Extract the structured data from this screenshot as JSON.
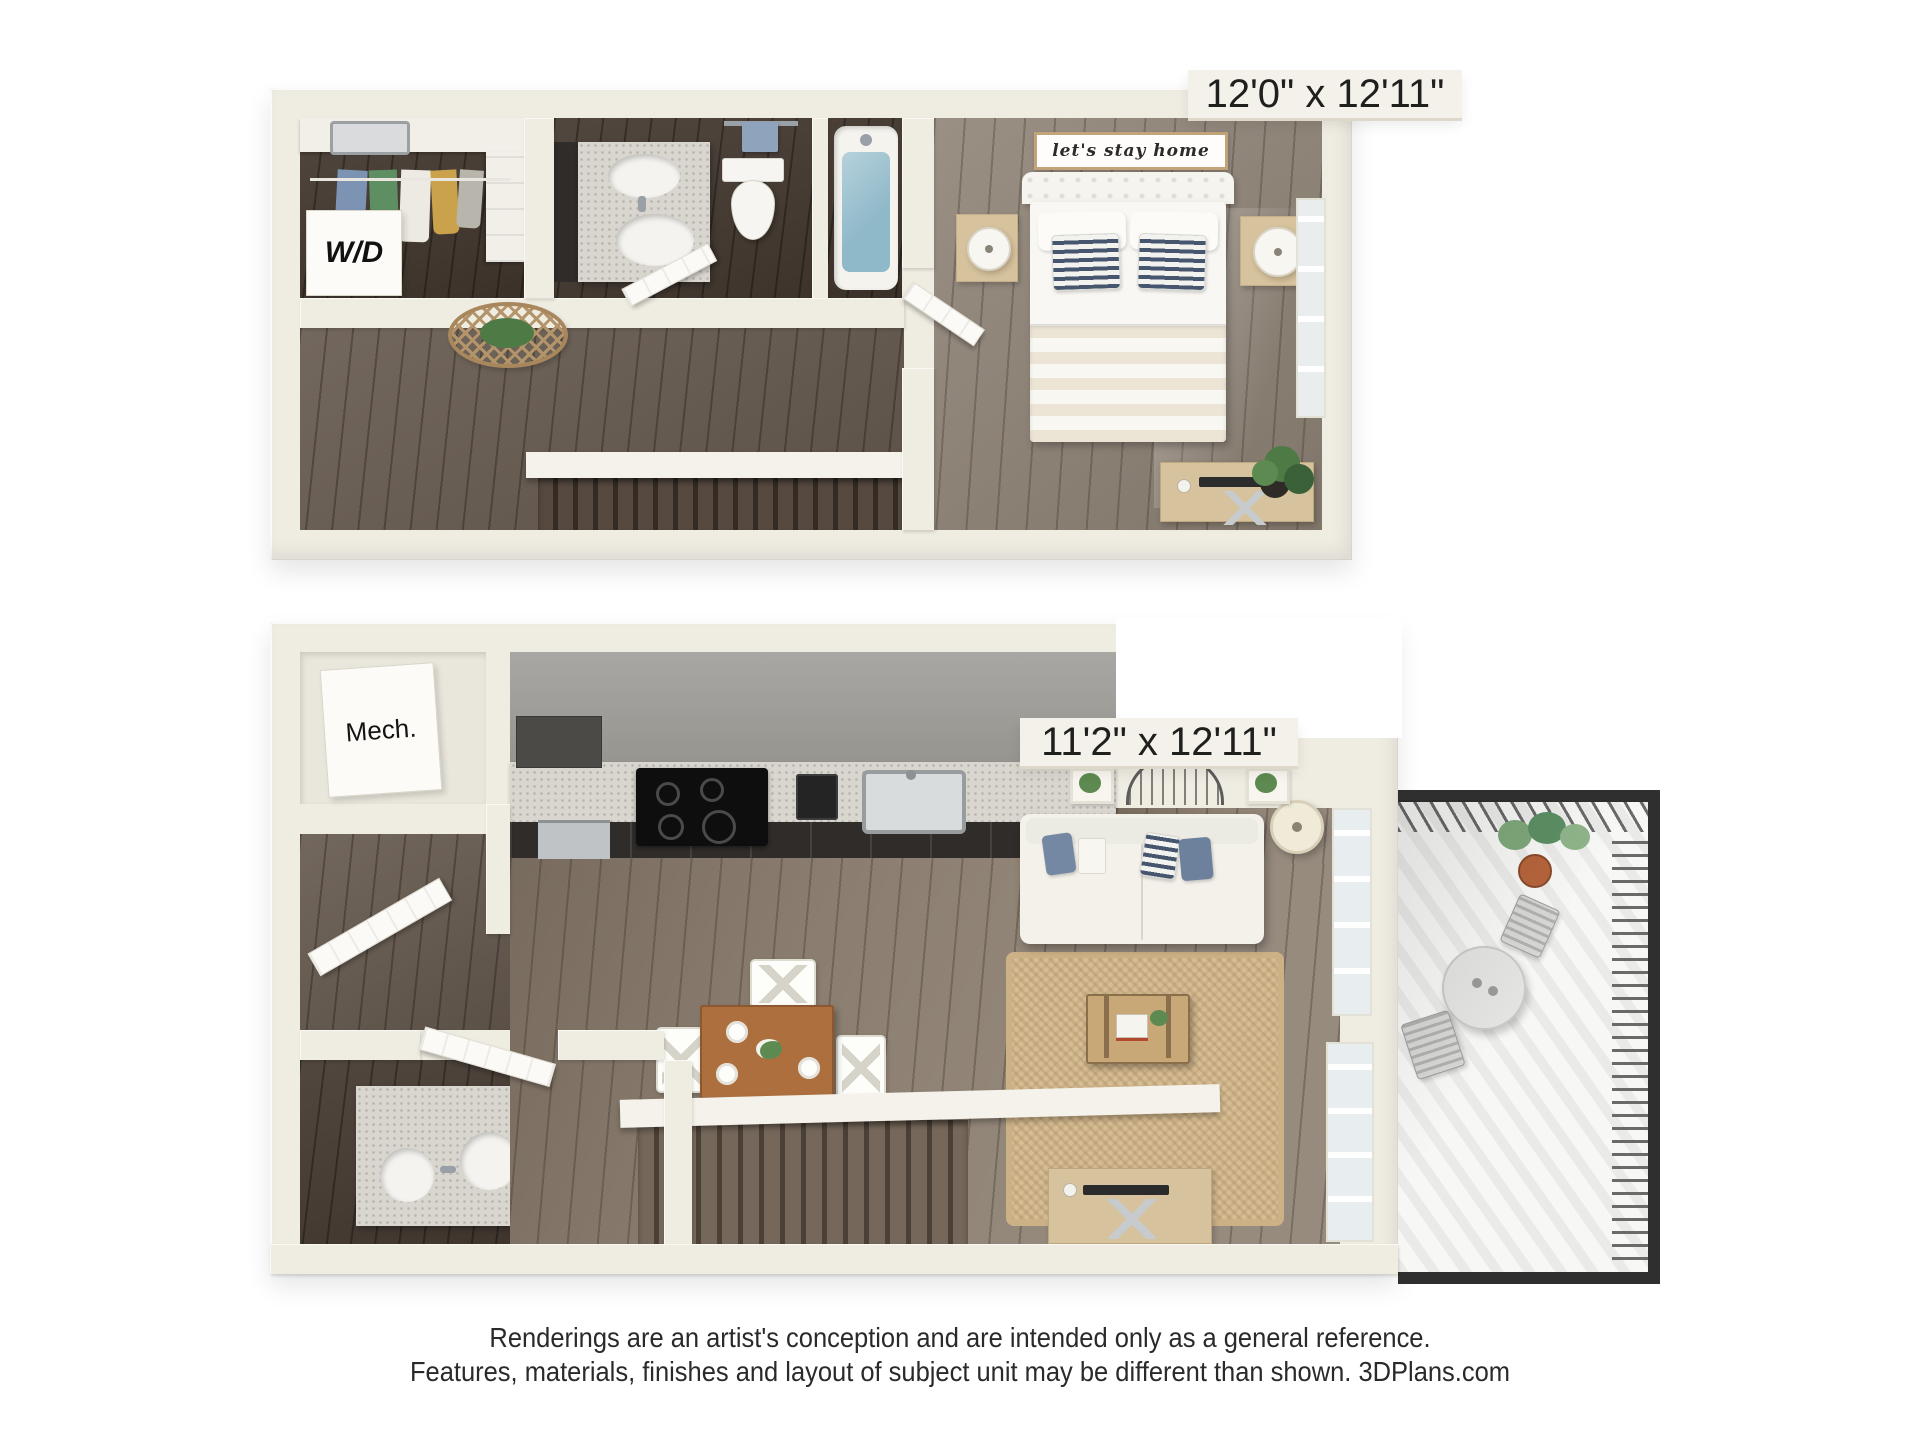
{
  "upper_floor": {
    "dimension_label": "12'0\" x 12'11\"",
    "washer_dryer_label": "W/D",
    "wall_sign_text": "let's stay home"
  },
  "lower_floor": {
    "dimension_label": "11'2\" x 12'11\"",
    "mechanical_label": "Mech."
  },
  "footer": {
    "line1": "Renderings are an artist's conception and are intended only as a general reference.",
    "line2": "Features, materials, finishes and layout of subject unit may be different than shown. 3DPlans.com"
  },
  "colors": {
    "wall": "#efece2",
    "wall_deep": "#ddd8c9",
    "floor_dark": "#443930",
    "floor_mid": "#675b50",
    "floor_warm": "#8b7e70",
    "floor_bed": "#8f8376",
    "water": "#8fb9c9",
    "granite": "#d9d6cf",
    "cabinet_dark": "#2f2c29",
    "kitchen_wall": "#a8a7a4",
    "stainless": "#bfc3c5",
    "rug": "#d7bd93",
    "wood_table": "#ad6f3e",
    "wood_light": "#d6c29c",
    "wood_trunk": "#c9a878",
    "sofa": "#f3f1ea",
    "pillow_blue": "#7487a3",
    "pillow_navy": "#47566f",
    "plant": "#4e7a46",
    "railing": "#2f2f2f",
    "balcony_floor": "#f7f7f5",
    "tag_bg": "#f3f1ea",
    "ink": "#1f1f1d",
    "door": "#fbfaf6",
    "page": "#ffffff"
  }
}
